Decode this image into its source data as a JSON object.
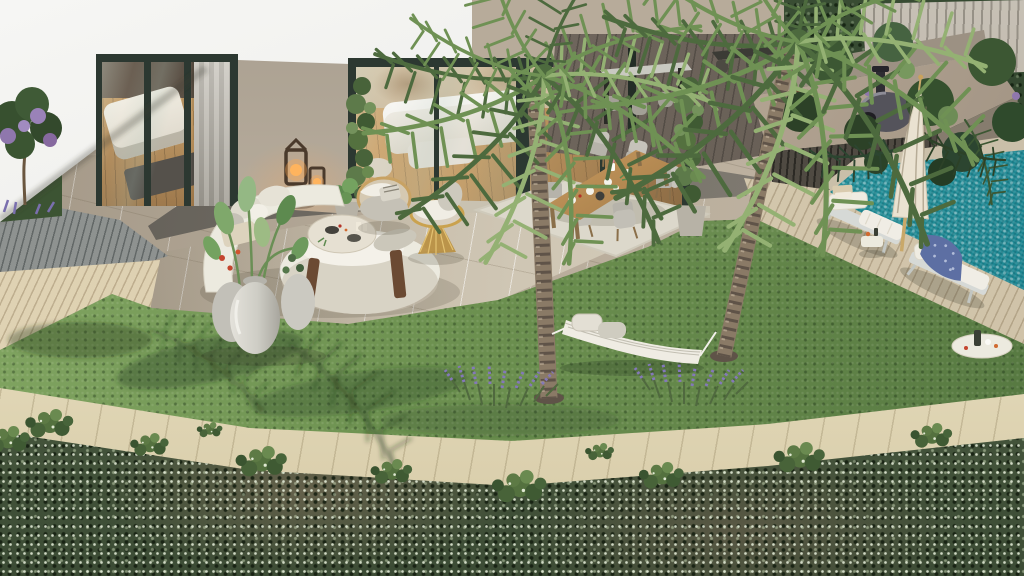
{
  "scene": {
    "type": "photorealistic 3D architectural rendering",
    "setting": "Aerial view of a luxury villa backyard with lawn, two palm trees, hammock, lounge terrace, outdoor dining, pergola bar, outdoor kitchen and a mosaic pool",
    "lighting": "warm late-afternoon sunlight from the right",
    "text_on_screen": []
  },
  "palette": {
    "building_white": "#efefec",
    "building_shade": "#d7d6d1",
    "stucco_wall": "#b9ae9e",
    "frame_dark": "#2c3831",
    "interior_floor": "#c39a63",
    "interior_wall": "#cdbb9e",
    "curtain_grey": "#c6c2b9",
    "tile_taupe": "#b7ab9a",
    "tile_dark": "#767168",
    "tile_cream": "#cfc6b4",
    "deck_light": "#d8caab",
    "deck_grey": "#8e9290",
    "pergola_deck": "#6a6158",
    "lawn_light": "#83a763",
    "lawn_mid": "#6d9150",
    "lawn_dark": "#567841",
    "palm_light": "#94b173",
    "palm_green": "#6f9154",
    "palm_dark": "#4d6a3e",
    "trunk_light": "#8a7a66",
    "trunk_dark": "#5f5348",
    "lavender_purple": "#8478ba",
    "lavender_stem": "#50693f",
    "pool_light": "#6ecec2",
    "pool_mid": "#2a99a0",
    "pool_deep": "#17808d",
    "pool_deck": "#cfc2a8",
    "coping_stone": "#cabfa9",
    "ledge_light": "#f0e8cc",
    "ledge_shade": "#d5c9a5",
    "hedge_green": "#49593f",
    "hedge_speckle": "rgba(232,240,220,0.85)",
    "sofa_white": "#eceadf",
    "cushion_grey": "#c5c1b6",
    "wicker_gold": "#c9a24f",
    "wood_dark": "#6b4a33",
    "rug_cream": "#dcd8cb",
    "table_wood": "#b98e55",
    "chair_grey": "#b6b3aa",
    "throw_blue": "#5d6fa3",
    "umbrella_cream": "#eae2d1",
    "towel_beige": "#d9cbae",
    "counter_stone": "#b5a694",
    "slat_dark": "#4f4a42",
    "oven_grey": "#54535b",
    "urn_light": "#d6d4cc",
    "glow_warm": "rgba(255,170,90,0.30)"
  },
  "objects": [
    {
      "name": "villa-facade",
      "label": "white villa facade with roof overhang"
    },
    {
      "name": "bedroom-glass-doors",
      "label": "sliding glass doors to bedroom",
      "count": 1
    },
    {
      "name": "living-room-glass-wall",
      "label": "open glass wall to living room",
      "count": 1
    },
    {
      "name": "ivy-pillar",
      "label": "ivy-covered pillar",
      "count": 2
    },
    {
      "name": "candle-lantern",
      "label": "wooden candle lantern",
      "count": 2
    },
    {
      "name": "curved-sofa",
      "label": "curved white boucle sofa",
      "count": 1
    },
    {
      "name": "coffee-table",
      "label": "round travertine coffee table",
      "count": 1
    },
    {
      "name": "wicker-armchair",
      "label": "rattan armchair",
      "count": 2
    },
    {
      "name": "planter-urn",
      "label": "large ceramic urn with tropical plants",
      "count": 3
    },
    {
      "name": "dining-table",
      "label": "wooden outdoor dining table, set",
      "count": 1
    },
    {
      "name": "dining-chair",
      "label": "upholstered dining chair",
      "count": 6
    },
    {
      "name": "area-rug",
      "label": "outdoor area rug",
      "count": 1
    },
    {
      "name": "pergola-bar",
      "label": "pergola bar table with stools",
      "count": 1
    },
    {
      "name": "outdoor-kitchen",
      "label": "concrete outdoor kitchen counter",
      "count": 1
    },
    {
      "name": "pizza-oven",
      "label": "dome pizza oven",
      "count": 1
    },
    {
      "name": "palm-tree",
      "label": "palm tree",
      "count": 2
    },
    {
      "name": "hammock",
      "label": "white hammock between palms",
      "count": 1
    },
    {
      "name": "lavender-patch",
      "label": "lavender planting at palm base",
      "count": 2
    },
    {
      "name": "lawn",
      "label": "manicured green lawn"
    },
    {
      "name": "pool",
      "label": "teal mosaic swimming pool"
    },
    {
      "name": "sun-lounger",
      "label": "poolside sun lounger",
      "count": 2
    },
    {
      "name": "pool-umbrella",
      "label": "closed cream parasol",
      "count": 1
    },
    {
      "name": "pool-side-table",
      "label": "poolside drinks table",
      "count": 1
    },
    {
      "name": "serving-tray",
      "label": "serving tray with drinks",
      "count": 1
    },
    {
      "name": "blue-throw",
      "label": "patterned blue throw on lounger",
      "count": 1
    },
    {
      "name": "wood-deck",
      "label": "timber deck strips",
      "count": 2
    },
    {
      "name": "stone-ledge",
      "label": "stone boundary ledge"
    },
    {
      "name": "flowering-hedge",
      "label": "ivy hedge with white blossoms"
    },
    {
      "name": "blossom-tree",
      "label": "small purple blossom tree",
      "count": 1
    }
  ]
}
